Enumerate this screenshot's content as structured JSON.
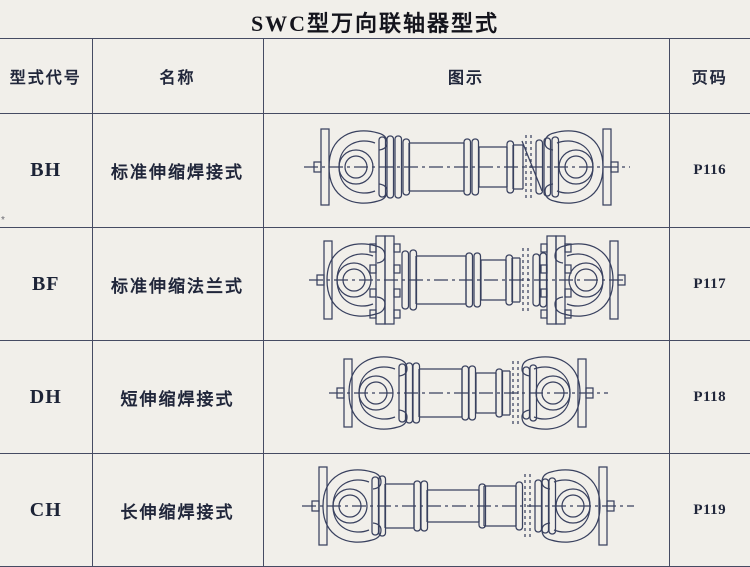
{
  "title": "SWC型万向联轴器型式",
  "margin_mark": "*",
  "colors": {
    "paper": "#f1efea",
    "table_line": "#464b63",
    "ink": "#1d2232",
    "drawing_line": "#39415f"
  },
  "table": {
    "headers": {
      "code": "型式代号",
      "name": "名称",
      "illustration": "图示",
      "page": "页码"
    },
    "rows": [
      {
        "code": "BH",
        "name": "标准伸缩焊接式",
        "page": "P116",
        "drawing_variant": "BH"
      },
      {
        "code": "BF",
        "name": "标准伸缩法兰式",
        "page": "P117",
        "drawing_variant": "BF"
      },
      {
        "code": "DH",
        "name": "短伸缩焊接式",
        "page": "P118",
        "drawing_variant": "DH"
      },
      {
        "code": "CH",
        "name": "长伸缩焊接式",
        "page": "P119",
        "drawing_variant": "CH"
      }
    ]
  }
}
